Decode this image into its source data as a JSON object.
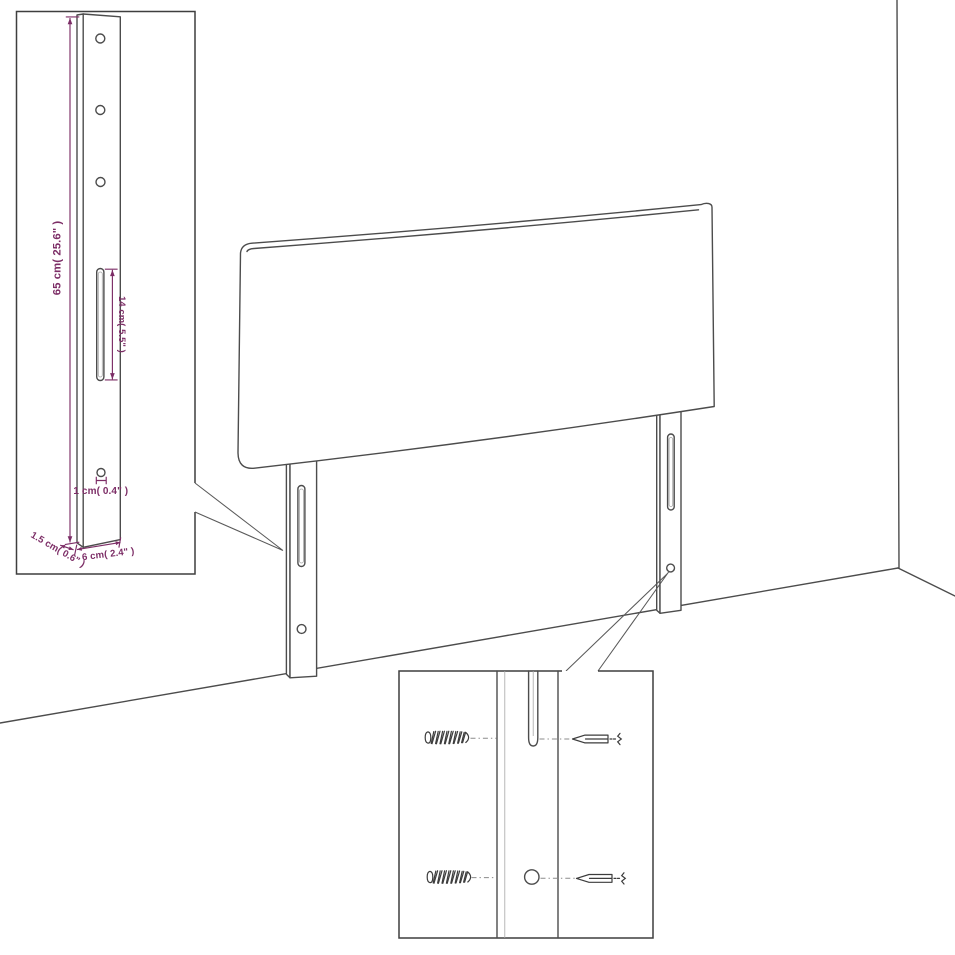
{
  "page": {
    "background": "#ffffff",
    "type": "furniture-dimension-diagram",
    "subject": "Headboard with two slotted mounting legs shown against a room corner, with a leg-detail inset at top left and a screw/hardware detail inset at bottom center"
  },
  "colors": {
    "outline_gray": "#4c4c4c",
    "inset_border_gray": "#3f3f3f",
    "dimension_purple": "#7C2D66"
  },
  "leg_detail_inset": {
    "top_hole_count": 3,
    "dim_leg_height": "65 cm( 25.6\" )",
    "dim_slot_length": "14 cm( 5.5\" )",
    "dim_hole_diameter": "1 cm( 0.4\" )",
    "dim_side_thickness": "1.5 cm( 0.6\" )",
    "dim_leg_width": "6 cm( 2.4\" )"
  }
}
